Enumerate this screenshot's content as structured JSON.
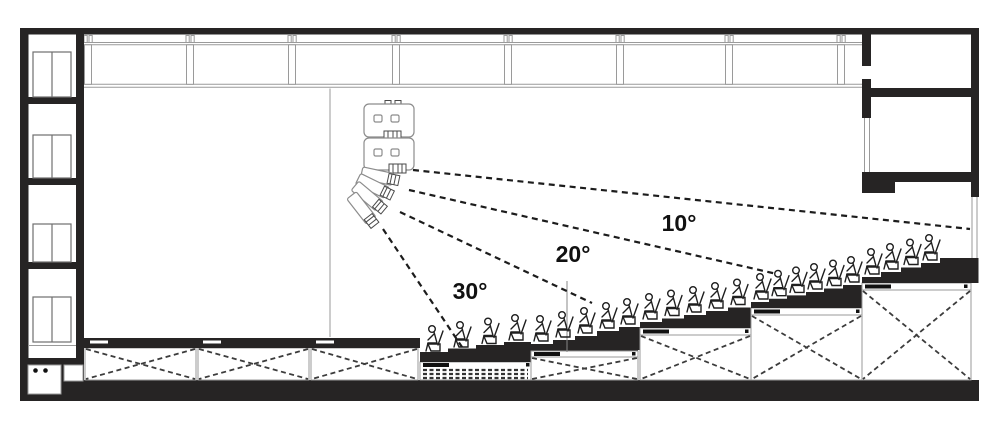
{
  "drawing": {
    "kind": "architectural-section",
    "subject": "Auditorium longitudinal section: flown line-array loudspeaker with dashed vertical coverage aiming lines over stepped (raked) seating tiers",
    "background": "#ffffff",
    "ink_color": "#262424",
    "detail_gray": "#9a9a9a"
  },
  "labels": {
    "angle_upper": "10°",
    "angle_middle": "20°",
    "angle_lower": "30°"
  },
  "coverage_angles_deg": [
    10,
    20,
    30
  ],
  "seating": {
    "tier_count": 5,
    "audience_figure_count": 24,
    "understage_bay_count": 3
  },
  "elevator_shaft": {
    "door_count": 4
  }
}
